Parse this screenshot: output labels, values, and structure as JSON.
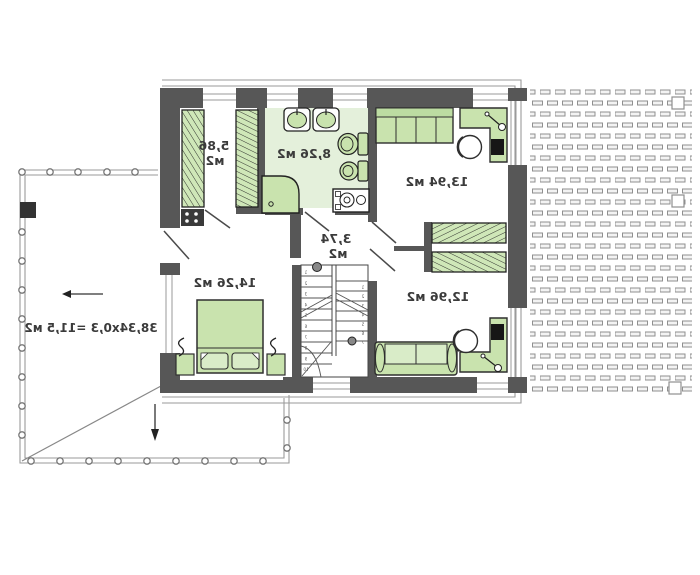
{
  "plan": {
    "text_mirrored": true,
    "rooms": {
      "wardrobe": {
        "area_line1": "5,86",
        "area_line2": "м2"
      },
      "bathroom": {
        "area": "8,26 м2"
      },
      "bedroom_top_right": {
        "area": "13,94 м2"
      },
      "hall": {
        "area_line1": "3,74",
        "area_line2": "м2"
      },
      "bedroom_left": {
        "area": "14,26 м2"
      },
      "room_bottom_right": {
        "area": "12,96 м2"
      }
    },
    "terrace": {
      "area_formula": "38,34x0,3 =11,5 м2"
    },
    "stairs": {
      "left_flight_steps": 10,
      "right_flight_steps": 7
    },
    "colors": {
      "wall": "#575757",
      "furniture": "#c9e3ae",
      "bathroom_floor": "#e4f0db",
      "outline_gray": "#9a9a9a",
      "label_text": "#3b3b3b",
      "roof_dash": "#8f8f8f"
    }
  }
}
